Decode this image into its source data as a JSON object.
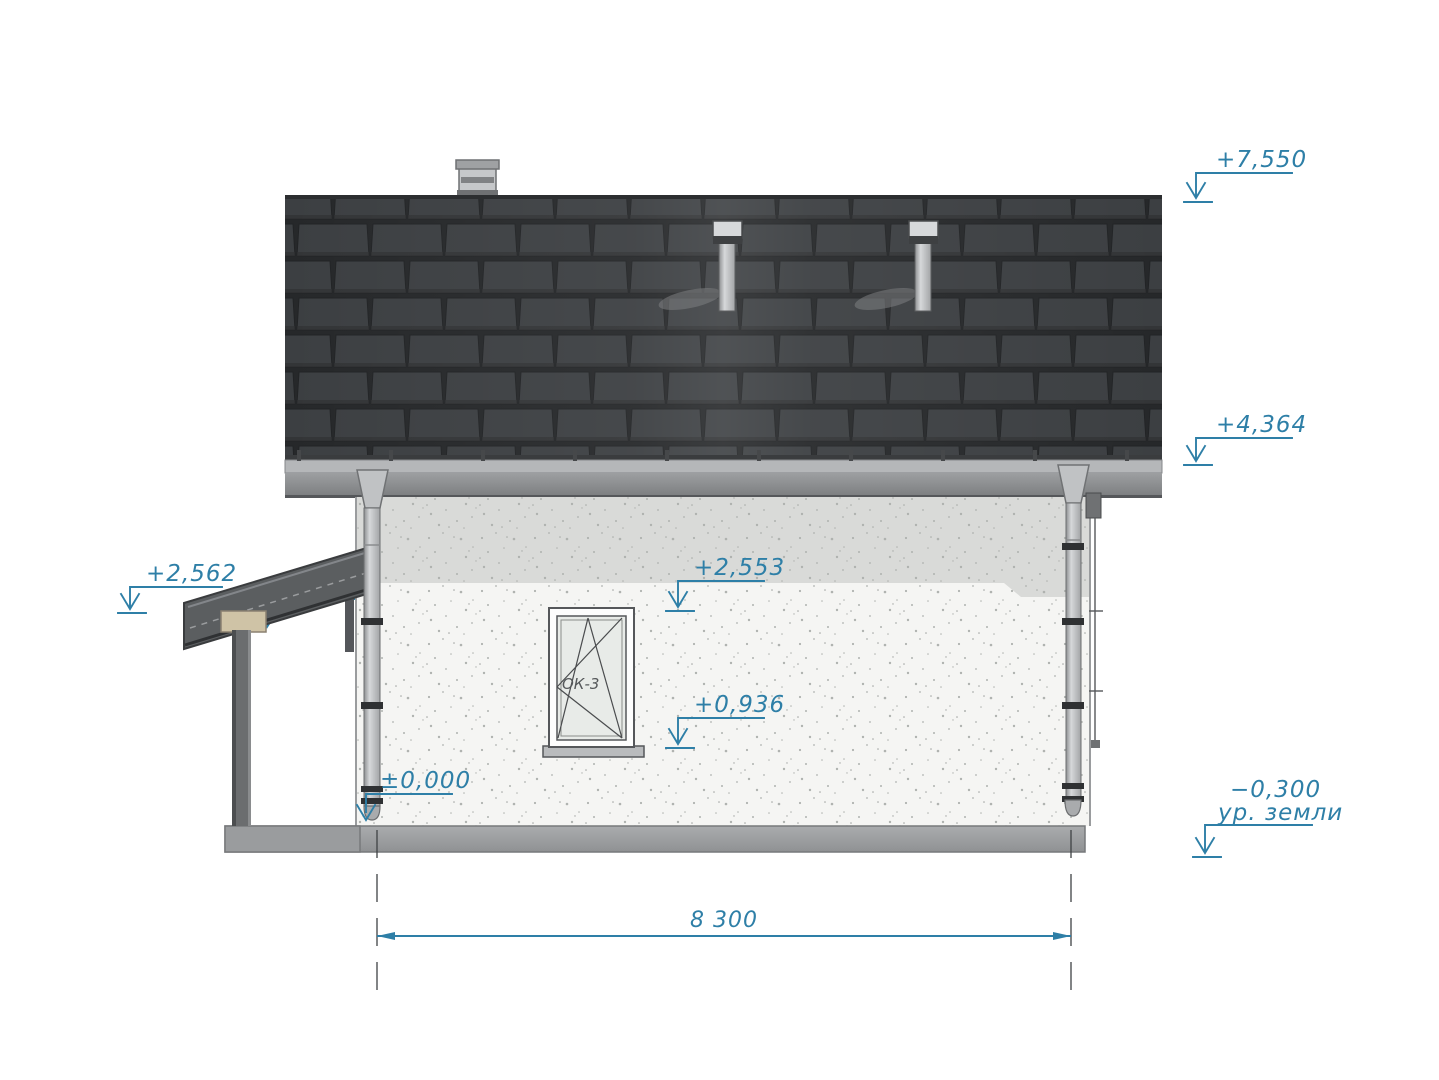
{
  "drawing": {
    "kind": "house side elevation drawing",
    "accent_color": "#2e7fa7",
    "roof_color": "#3c3f42",
    "marks": {
      "ridge": "+7,550",
      "eave": "+4,364",
      "canopy_edge": "+2,562",
      "canopy_top": "+2,360",
      "lintel": "+2,553",
      "sill": "+0,936",
      "floor": "±0,000",
      "ground": "−0,300",
      "ground_label": "ур. земли"
    },
    "window": {
      "label": "ОК-3"
    },
    "dimension": {
      "overall_width": "8 300"
    }
  }
}
